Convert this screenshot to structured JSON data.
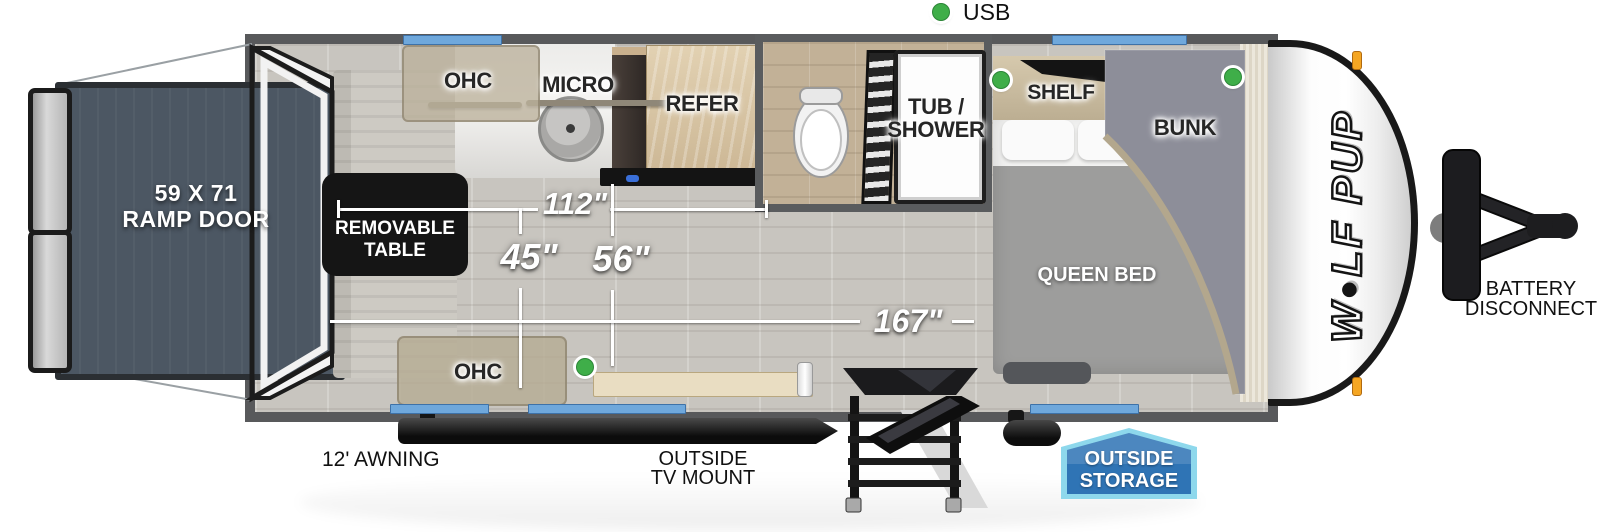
{
  "legend": {
    "usb": "USB"
  },
  "areas": {
    "ramp_door": {
      "line1": "59 X 71",
      "line2": "RAMP DOOR"
    },
    "removable_table": {
      "line1": "REMOVABLE",
      "line2": "TABLE"
    },
    "ohc_top": "OHC",
    "micro": "MICRO",
    "refer": "REFER",
    "tub_shower": {
      "line1": "TUB /",
      "line2": "SHOWER"
    },
    "shelf": "SHELF",
    "bunk": "BUNK",
    "queen_bed": "QUEEN BED",
    "ohc_bottom": "OHC"
  },
  "dimensions": {
    "galley_run": "112\"",
    "table_area": "45\"",
    "floor_width": "56\"",
    "interior_length": "167\""
  },
  "exterior": {
    "awning": "12' AWNING",
    "tv_mount": {
      "line1": "OUTSIDE",
      "line2": "TV MOUNT"
    },
    "outside_storage": {
      "line1": "OUTSIDE",
      "line2": "STORAGE"
    },
    "battery_disconnect": {
      "line1": "BATTERY",
      "line2": "DISCONNECT"
    },
    "brand": {
      "first": "W",
      "rest": "LF PUP"
    }
  },
  "colors": {
    "usb_dot": "#3fae49",
    "window": "#6fa8dc",
    "wall": "#58595b",
    "storage_badge_fill": "#2f74b5",
    "storage_badge_border": "#8ed8ec"
  }
}
